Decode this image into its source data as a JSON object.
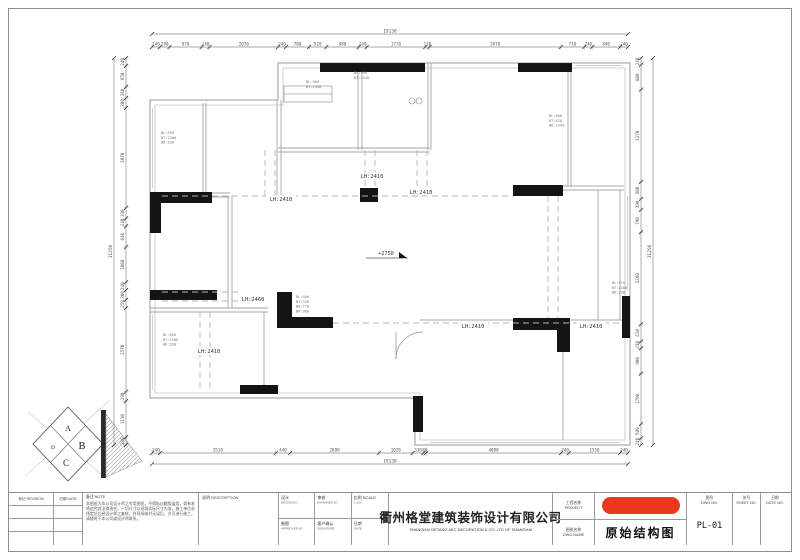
{
  "colors": {
    "accent_red": "#e8391e",
    "wall_gray": "#9a9a9a",
    "structure_black": "#141414",
    "dim_text": "#555555"
  },
  "dims": {
    "top": {
      "total": "19130",
      "segments": [
        "240",
        "290",
        "970",
        "240",
        "2070",
        "240",
        "700",
        "520",
        "980",
        "240",
        "1770",
        "130",
        "3970",
        "710",
        "240",
        "840",
        "240"
      ]
    },
    "bottom": {
      "total": "19130",
      "segments": [
        "240",
        "3510",
        "440",
        "2690",
        "1020",
        "330",
        "80",
        "4090",
        "240",
        "1550",
        "240"
      ]
    },
    "left": {
      "total": "11250",
      "segments": [
        "240",
        "650",
        "340",
        "300",
        "3070",
        "330",
        "240",
        "640",
        "1080",
        "240",
        "300",
        "250",
        "2570",
        "290",
        "1110",
        "240"
      ]
    },
    "right": {
      "total": "11250",
      "segments": [
        "240",
        "880",
        "3270",
        "600",
        "390",
        "790",
        "3260",
        "610",
        "240",
        "900",
        "1790",
        "500",
        "240"
      ]
    }
  },
  "plan": {
    "beam_labels": [
      "LH:2410",
      "LH:2410",
      "LH:2410",
      "LH:2460",
      "LH:2410",
      "LH:2410",
      "LH:2410"
    ],
    "level_label": "+2750",
    "annotations": [
      {
        "lines": [
          "BL:950",
          "BT:2300",
          "BD:330"
        ]
      },
      {
        "lines": [
          "BL:900",
          "BT:2440"
        ]
      },
      {
        "lines": [
          "BL:900",
          "BT:2440"
        ]
      },
      {
        "lines": [
          "BL:500",
          "BT:520",
          "BD:1490"
        ]
      },
      {
        "lines": [
          "BL:950",
          "BT:1500",
          "BD:330"
        ]
      },
      {
        "lines": [
          "BL:500",
          "BT:330",
          "BD:770",
          "BH:900"
        ]
      },
      {
        "lines": [
          "BL:970",
          "BT:2400",
          "BD:330"
        ]
      }
    ]
  },
  "titleblock": {
    "revision_header": "标记 REVISION",
    "date_header": "日期 DATE",
    "note_header": "备注  NOTE",
    "note_lines": [
      "本图纸为本公司设计师之专用图纸，不得私自翻版盗用，如有发现",
      "将追究其法律责任。一切尺寸以现场实际尺寸为准，施工单位必须在放",
      "线定位后经设计师之复核，并现场核对无误后，方可进行施工，如有疑问，",
      "请随时于本公司或设计师联系。"
    ],
    "description_header": "说明  DESCRIPTION",
    "fields": [
      {
        "cn": "设计",
        "en": "DESIGN BY"
      },
      {
        "cn": "审核",
        "en": "EXAMINED BY"
      },
      {
        "cn": "比例 SCALE",
        "en": "1:100"
      },
      {
        "cn": "制图",
        "en": "APPROVED BY"
      },
      {
        "cn": "客户确认",
        "en": "SIGNATURE"
      },
      {
        "cn": "日期",
        "en": "DATE"
      }
    ],
    "company_cn": "衢州格堂建筑装饰设计有限公司",
    "company_en": "SHANGHAI GETANG AEC DECORATION  &  CO. LTD OF SHANGHAI",
    "project_label_cn": "工程名称",
    "project_label_en": "PROJECT",
    "title_label_cn": "图纸名称",
    "title_label_en": "DWG.NAME",
    "drawing_title": "原始结构图",
    "dwgno_label_cn": "图号",
    "dwgno_label_en": "DWG NO.",
    "dwgno_value": "PL-01",
    "sheet_label_cn": "张号",
    "sheet_label_en": "SHEET NO.",
    "dateno_label_cn": "日期",
    "dateno_label_en": "DATE NO."
  },
  "logo": {
    "letters": [
      "A",
      "B",
      "C",
      "D"
    ]
  }
}
